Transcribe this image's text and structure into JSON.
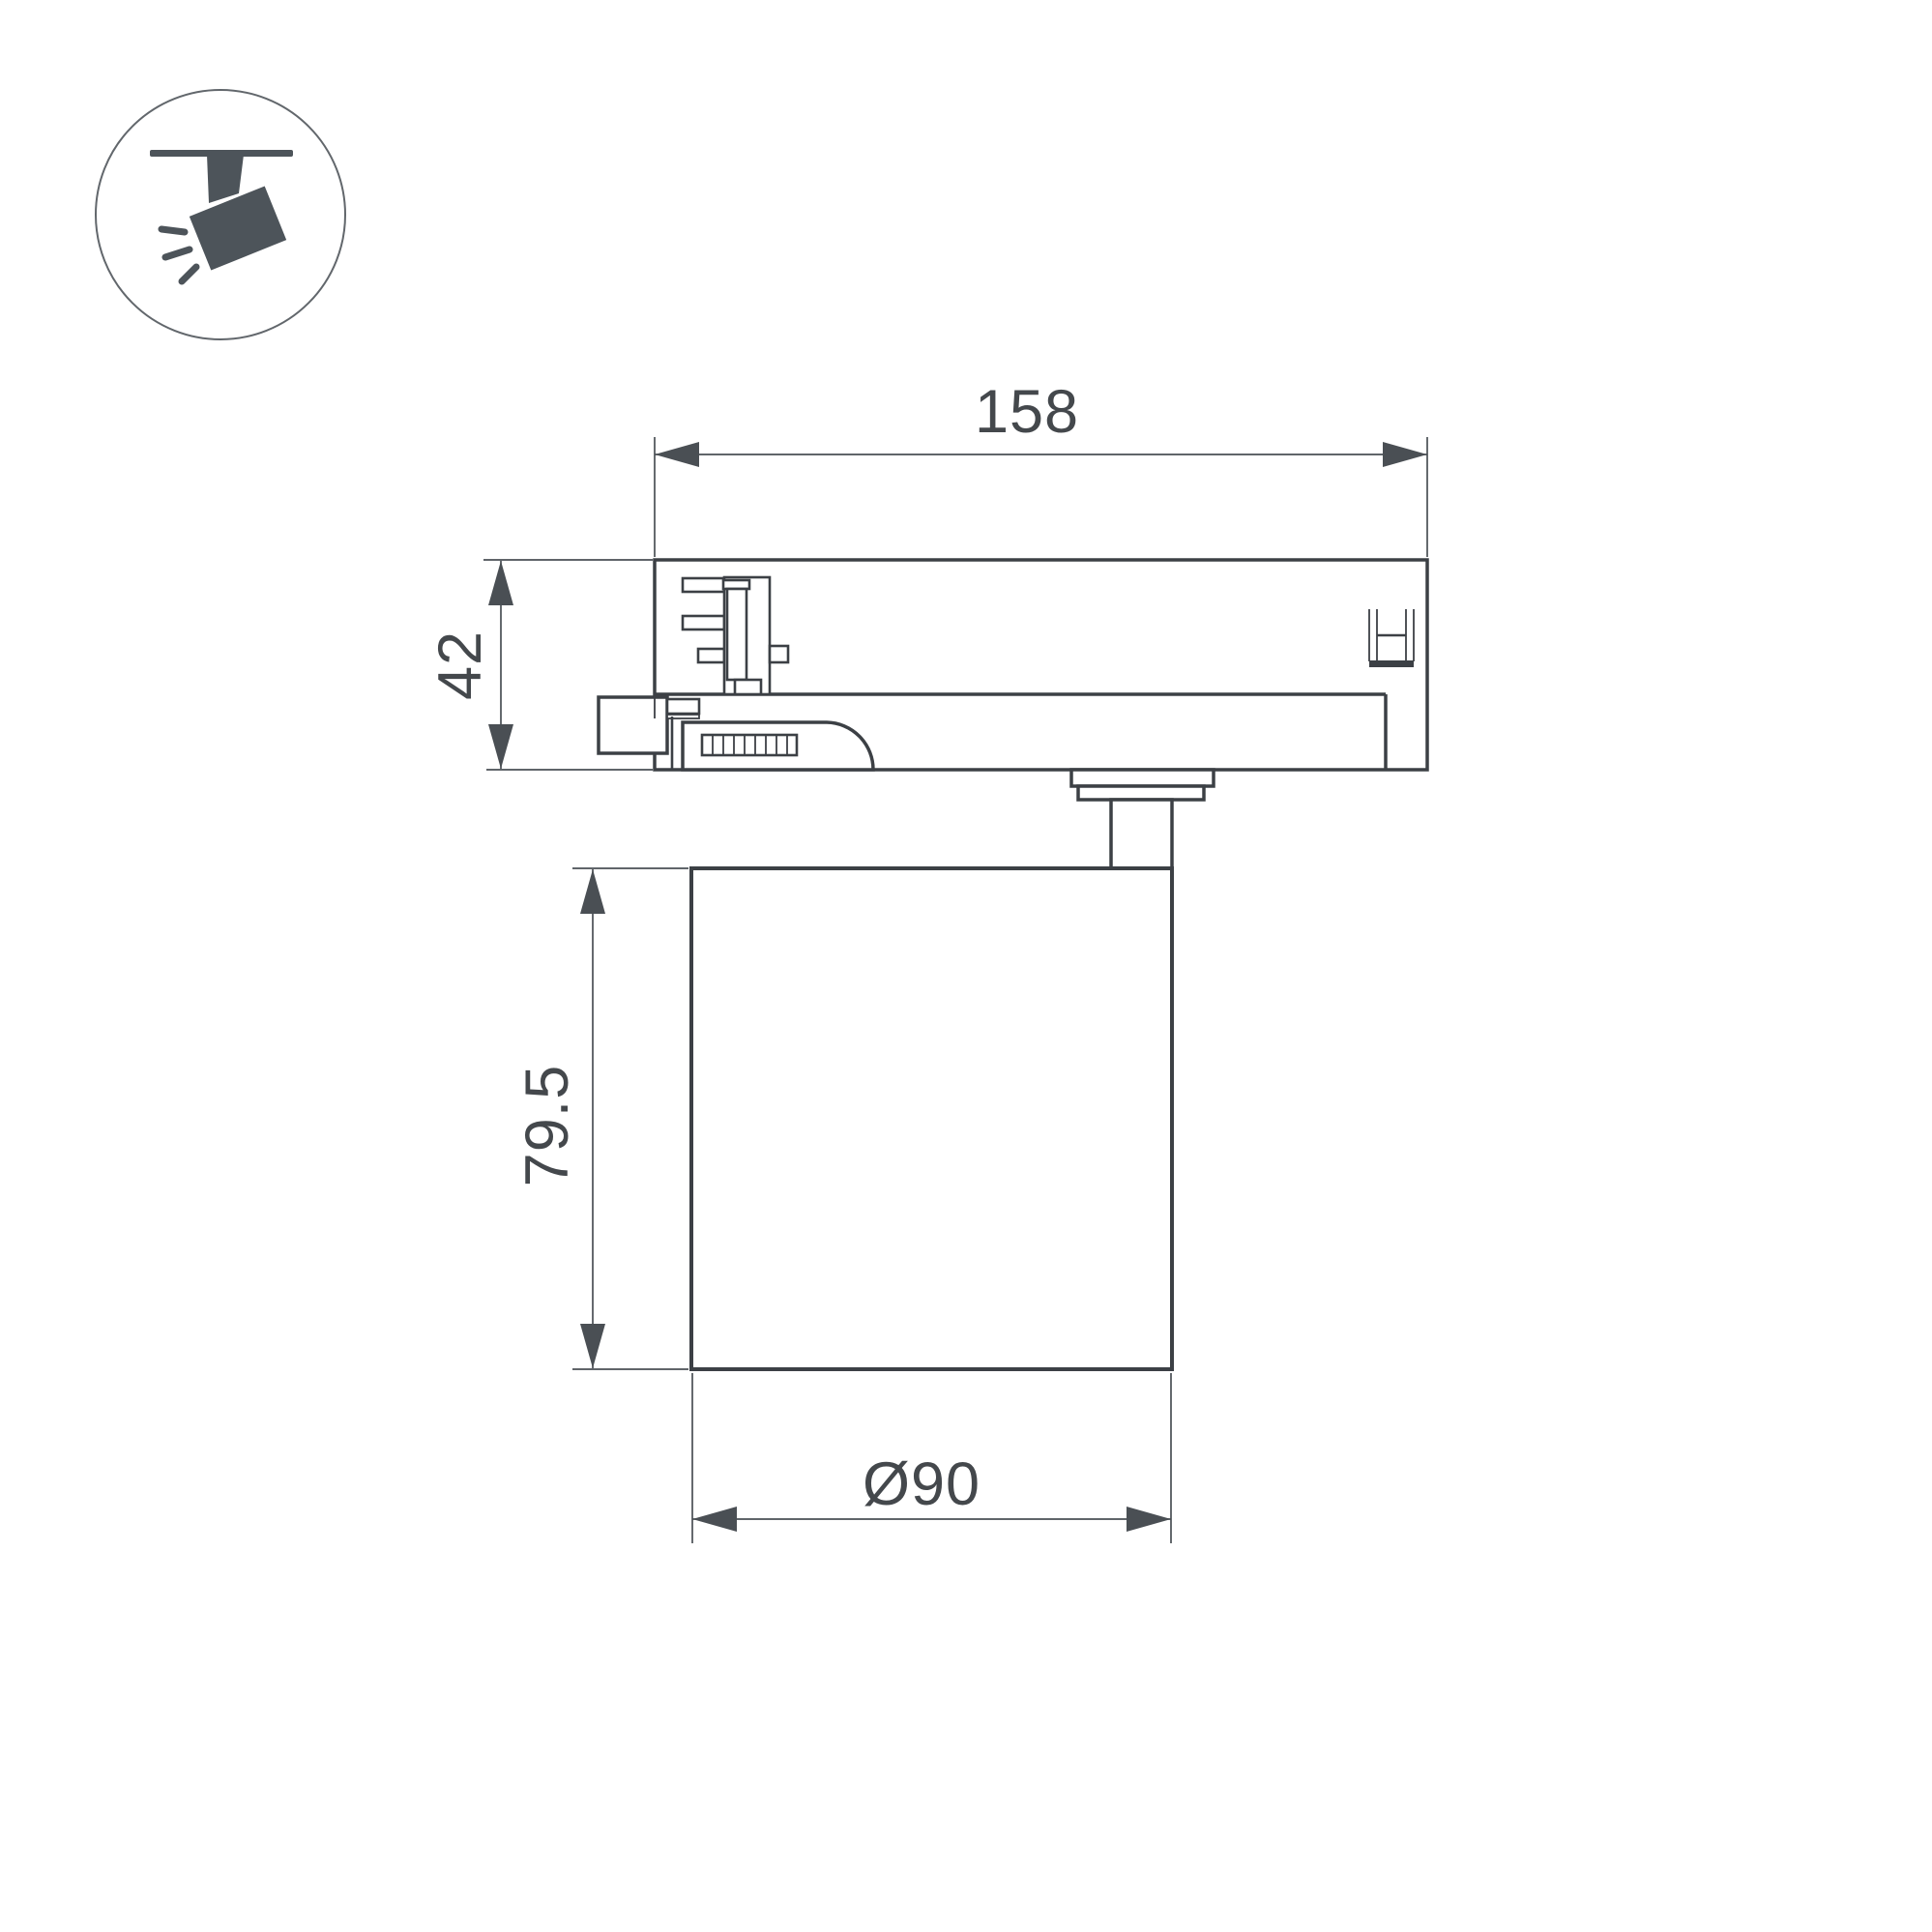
{
  "page": {
    "background_color": "#ffffff"
  },
  "icon": {
    "name": "ceiling-track-spotlight-icon",
    "glyph_color": "#4d545a",
    "circle_color": "#62676c"
  },
  "drawing": {
    "type": "technical-dimension-drawing",
    "subject": "track-mounted spotlight, side view",
    "line_color": "#3c4045",
    "dimension_color": "#4a4f54",
    "text_color": "#44484c",
    "dimensions": {
      "track_adapter_width": "158",
      "track_adapter_height": "42",
      "lamp_body_height": "79.5",
      "lamp_body_diameter": "Ø90"
    }
  }
}
